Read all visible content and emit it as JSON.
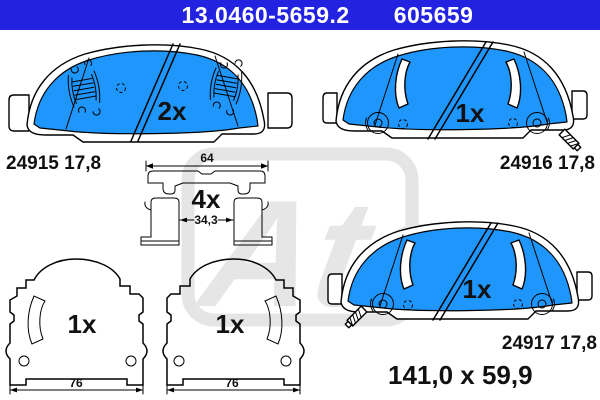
{
  "header": {
    "part_number": "13.0460-5659.2",
    "article_number": "605659"
  },
  "watermark": {
    "text": "Ate"
  },
  "parts": {
    "pad_top_left": {
      "qty": "2x",
      "part_no": "24915 17,8"
    },
    "pad_top_right": {
      "qty": "1x",
      "part_no": "24916 17,8"
    },
    "pad_bottom_right": {
      "qty": "1x",
      "part_no": "24917 17,8",
      "dimensions": "141,0 x 59,9"
    },
    "clip": {
      "qty": "4x",
      "outer_width": "64",
      "inner_width": "34,3"
    },
    "shim_left": {
      "qty": "1x",
      "width": "76"
    },
    "shim_right": {
      "qty": "1x",
      "width": "76"
    }
  },
  "colors": {
    "header_bg": "#2222E0",
    "header_text": "#FFFFFF",
    "pad_fill": "#1E96FB",
    "outline": "#000000",
    "watermark": "#E5E5E5"
  }
}
